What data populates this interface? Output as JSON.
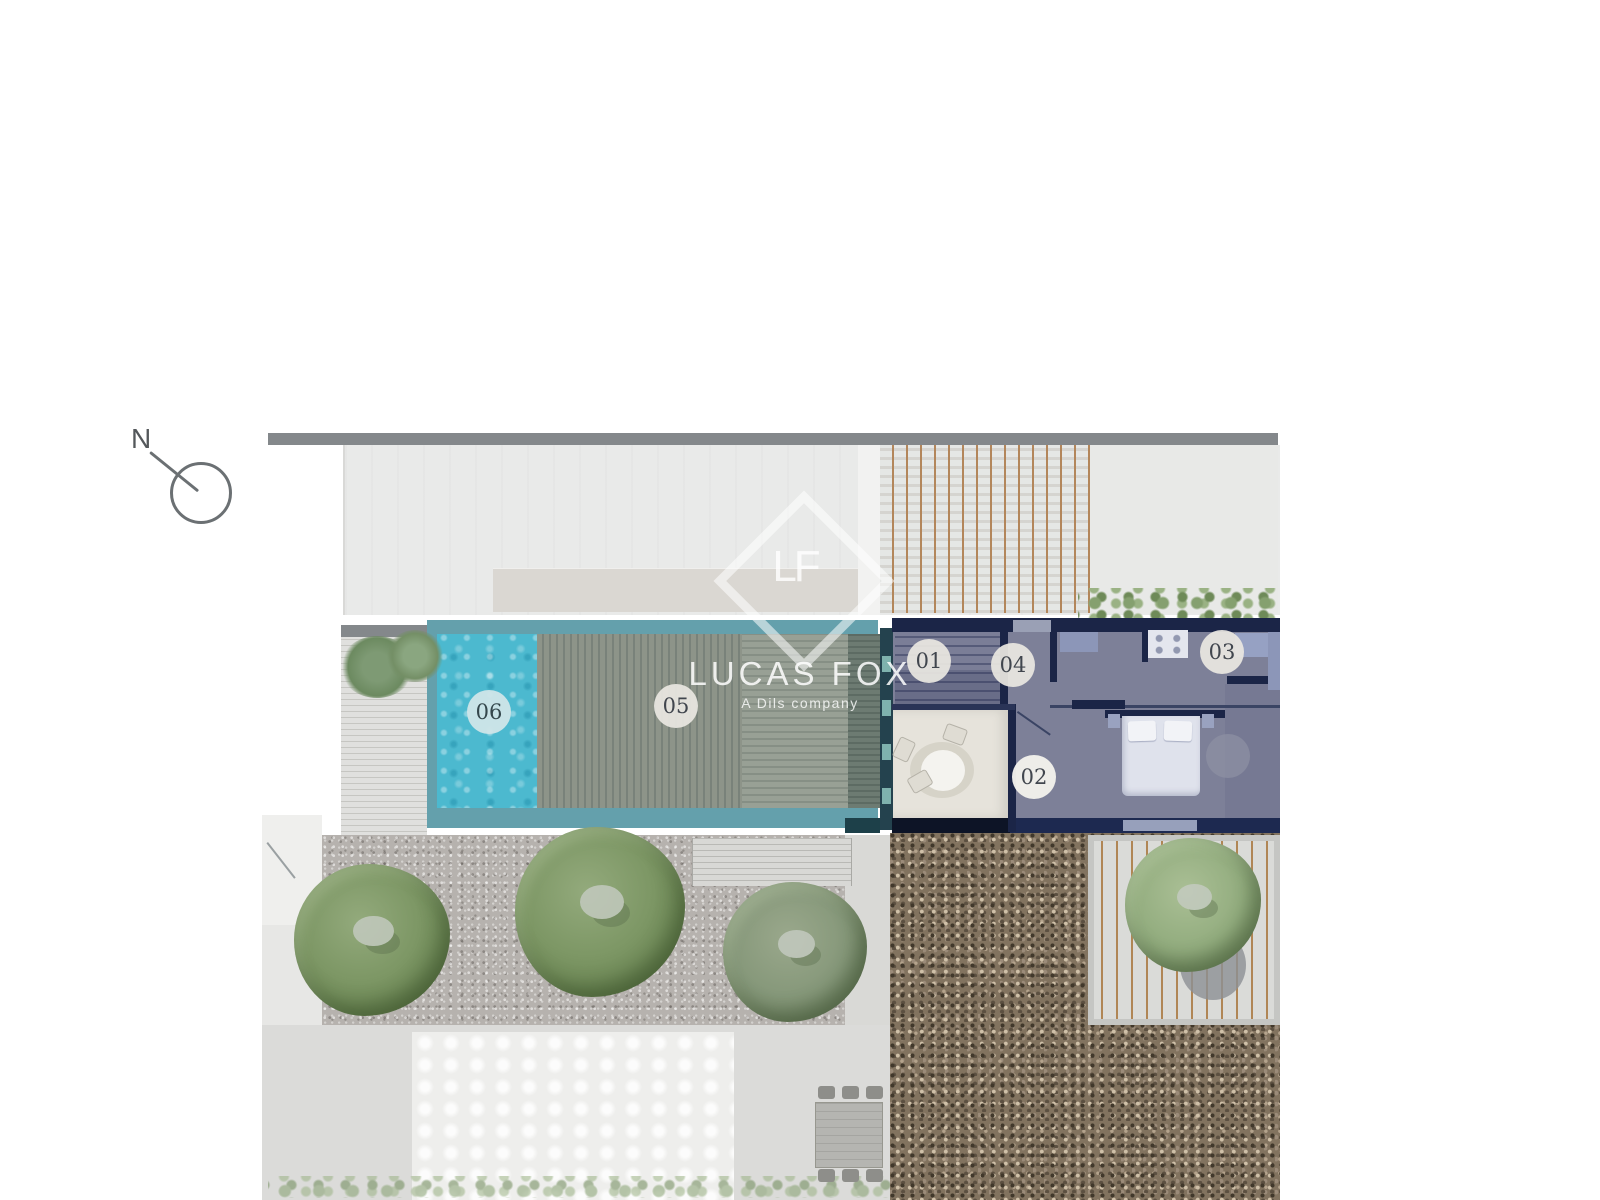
{
  "compass": {
    "label": "N"
  },
  "watermark": {
    "monogram": "LF",
    "brand": "LUCAS FOX",
    "tagline": "A Dils company"
  },
  "plan": {
    "unit_labels": [
      {
        "id": "unit-01",
        "text": "01"
      },
      {
        "id": "unit-02",
        "text": "02"
      },
      {
        "id": "unit-03",
        "text": "03"
      },
      {
        "id": "unit-04",
        "text": "04"
      },
      {
        "id": "unit-05",
        "text": "05"
      },
      {
        "id": "unit-06",
        "text": "06"
      }
    ]
  },
  "colors": {
    "pool": "#4cb9cf",
    "pool_frame": "#64a0ac",
    "wall_navy": "#1b2547",
    "wall_gray": "#84888b",
    "deck_wood": "#8d9489",
    "gravel_light": "#b6b2ae",
    "pebbles_dark": "#82735f",
    "tree_green": "#7d9765",
    "badge_bg": "#eae7e1",
    "badge_text": "#41464e"
  }
}
